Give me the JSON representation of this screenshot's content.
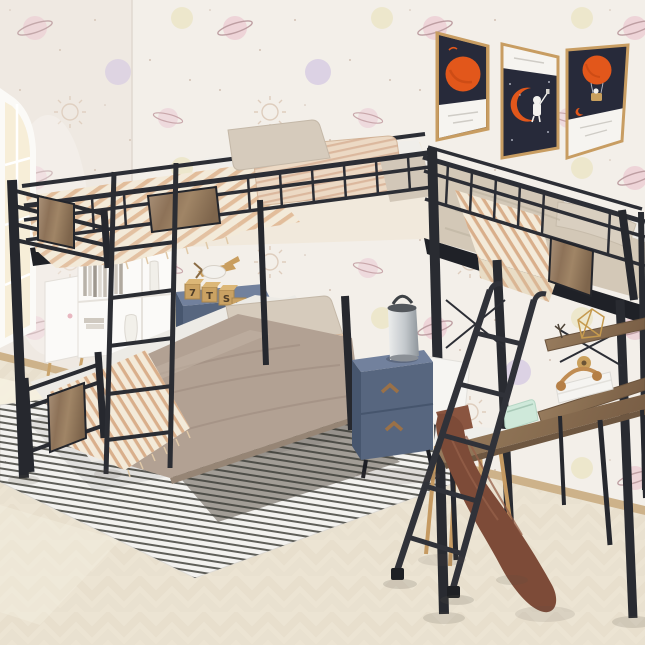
{
  "meta": {
    "domain": "Natural-Image",
    "subject": "Kids bedroom product photo: black metal L-shaped triple bunk bed (twin-over-twin bunk plus side loft bed with desk and shelves)",
    "canvas": {
      "width": 645,
      "height": 645
    }
  },
  "palette": {
    "wall": "#f3efe9",
    "wall_left": "#efe9e2",
    "corner_line": "#e0d8d0",
    "floor": "#ece4d3",
    "baseboard": "#cdb28a",
    "metal": "#2c2e35",
    "metal_dark": "#23252b",
    "rim_dark": "#1f2127",
    "sheet_white": "#edebe6",
    "bedding_light": "#f3ead9",
    "comforter_taupe": "#b2a193",
    "comforter_loft": "#d3c8b7",
    "pillow_beige": "#d6cbbc",
    "pillow_striped_base": "#ecd9c4",
    "nightstand_top": "#72819d",
    "nightstand_front": "#57667f",
    "nightstand_side": "#47566e",
    "handle_wood": "#9a7148",
    "rug_white": "#f3f2ef",
    "rug_stripe": "#45453f",
    "rug_grey": "#a29d96",
    "poster_navy": "#272a3a",
    "poster_orange": "#e2571b",
    "poster_white": "#f6f4f0",
    "frame_gold": "#c89d62",
    "blanket_brown": "#7d4b38",
    "mint": "#cfe9da",
    "chair_white": "#f6f5f2",
    "chair_leg": "#c59a62",
    "lamp_top": "#53575c",
    "toy_wood": "#caa263",
    "white_shelf": "#fbfaf8",
    "window_light": "#f7eed8"
  },
  "scene": {
    "room": {
      "wallpaper": "pastel planets, saturn rings and suns on off-white",
      "floor": "light herringbone wood",
      "window": "arched window on left wall"
    },
    "posters": [
      {
        "name": "orange-planet-poster",
        "art": "large orange planet on navy, white caption band below"
      },
      {
        "name": "astronaut-moon-poster",
        "art": "astronaut with selfie stick sitting on orange crescent moon, white caption band above"
      },
      {
        "name": "hot-air-balloon-poster",
        "art": "orange hot air balloon with astronaut basket on navy, white caption band below"
      }
    ],
    "bed": {
      "type": "L-shaped triple bunk bed",
      "frame": "black metal with rustic grey-wood panel inserts",
      "upper_bunk": "tan striped duvet with fringe, beige and striped pillows",
      "lower_bunk": "taupe comforter, white sheet, beige pillow, striped pillow, striped fringed throw at foot",
      "loft_bed": "beige comforter, striped throw, pillow at wall end",
      "ladders": [
        "integrated vertical ladder on bunk side",
        "leaning ladder against loft"
      ]
    },
    "desk_area": {
      "desk": "rustic wood desk built under loft",
      "shelves": 2,
      "items": [
        "mint pouch",
        "white book stack",
        "tan headphones",
        "tape roll",
        "gold wire decor",
        "dry twig"
      ]
    },
    "chair": "white shell chair with wooden legs",
    "nightstands": [
      {
        "color": "slate blue",
        "drawers": 2,
        "items": [
          "wooden toy plane",
          "alphabet blocks"
        ]
      },
      {
        "color": "slate blue",
        "drawers": 2,
        "items": [
          "grey metal lamp"
        ]
      }
    ],
    "toy_blocks_letters": [
      "7",
      "T",
      "S",
      "K"
    ],
    "bookshelf": {
      "color": "white",
      "contents": [
        "books",
        "white vases"
      ],
      "legs": "tapered wood"
    },
    "rug": "white rug with thin dark stripes and grey striped panel",
    "blanket": "rust-brown throw draped over desk corner to floor"
  }
}
